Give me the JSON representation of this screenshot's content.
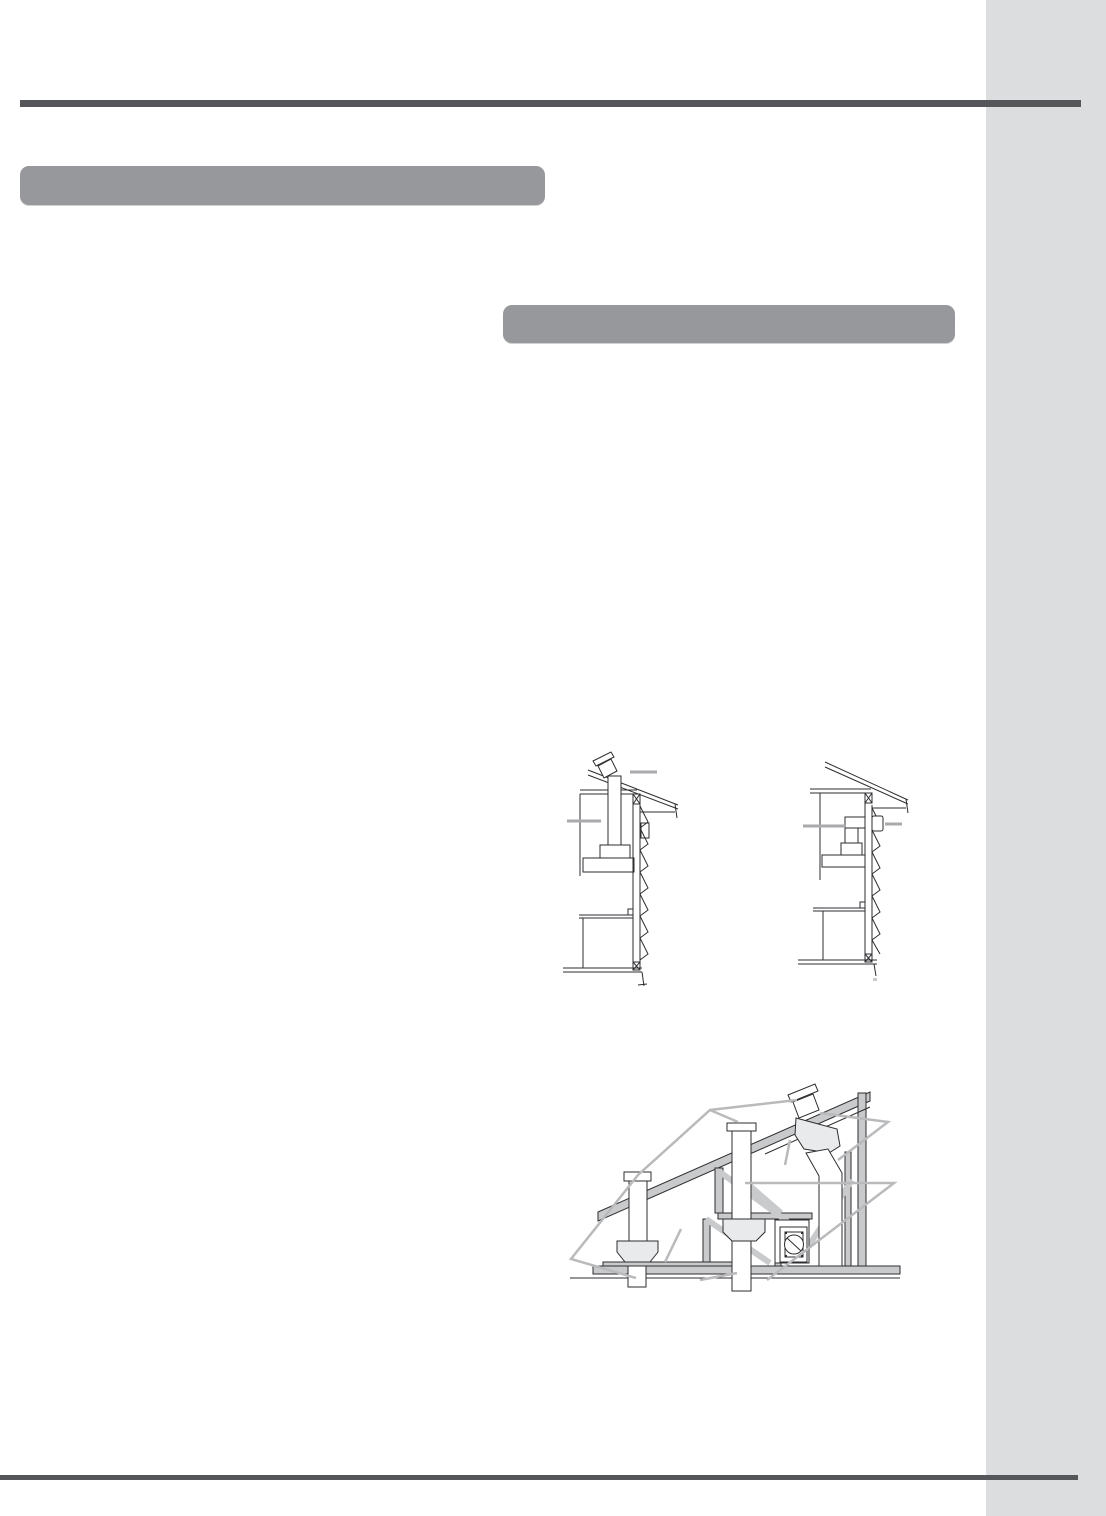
{
  "page": {
    "background_color": "#ffffff",
    "side_column_color": "#dcddde",
    "rule_color": "#55565a",
    "section_bar_color": "#97989b",
    "diagram_line_color": "#2e2e30",
    "diagram_structure_fill": "#c9cacb",
    "diagram_jack_fill": "#e9eaec",
    "diagram_callout_color": "#b9babc",
    "diagram_marker_color": "#a9aaac"
  },
  "sections": [
    {
      "id": "section-header-1",
      "label": ""
    },
    {
      "id": "section-header-2",
      "label": ""
    }
  ],
  "figures": [
    {
      "id": "roof-venting-cross-section",
      "description": "house cross-section, duct vented vertically through roof"
    },
    {
      "id": "wall-venting-cross-section",
      "description": "house cross-section, duct vented horizontally through wall"
    },
    {
      "id": "roof-jack-installation",
      "description": "attic framing with three roof jacks, ducts and round wall cap"
    }
  ]
}
